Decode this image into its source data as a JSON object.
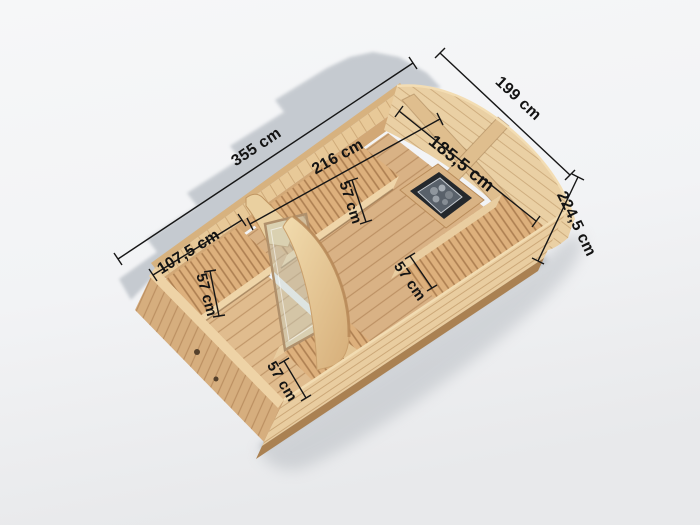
{
  "render": {
    "type": "3d-product-dimension-view",
    "subject": "wooden sauna cabin, cutaway top view with interior",
    "rooms": [
      "changing-room",
      "sauna-room"
    ],
    "features": [
      "arched-rear-gable",
      "glass-door",
      "curved-partition-panel",
      "sauna-heater-with-stones",
      "slatted-benches"
    ]
  },
  "dimensions": {
    "length_total": "355 cm",
    "width_total": "199 cm",
    "height_total": "224,5 cm",
    "width_interior": "185,5 cm",
    "bench_main_length": "216 cm",
    "bench_main_depth": "57 cm",
    "bench_front_length": "107,5 cm",
    "bench_front_depth": "57 cm",
    "bench_front_side_depth": "57 cm",
    "bench_sauna_side_depth": "57 cm"
  },
  "colors": {
    "background_top": "#f6f7f8",
    "background_bottom": "#e8e9eb",
    "backdrop_shadow": "#b9bfc6",
    "wood_light": "#efd5a9",
    "wood_mid": "#ddb07c",
    "wood_wall": "#e9cda0",
    "wood_dark": "#aa8152",
    "dimension_line": "#161616",
    "heater_body": "#24282c",
    "heater_metal": "#59616a",
    "heater_stones": "#9aa1a8",
    "glass": "#c4d2c8"
  }
}
